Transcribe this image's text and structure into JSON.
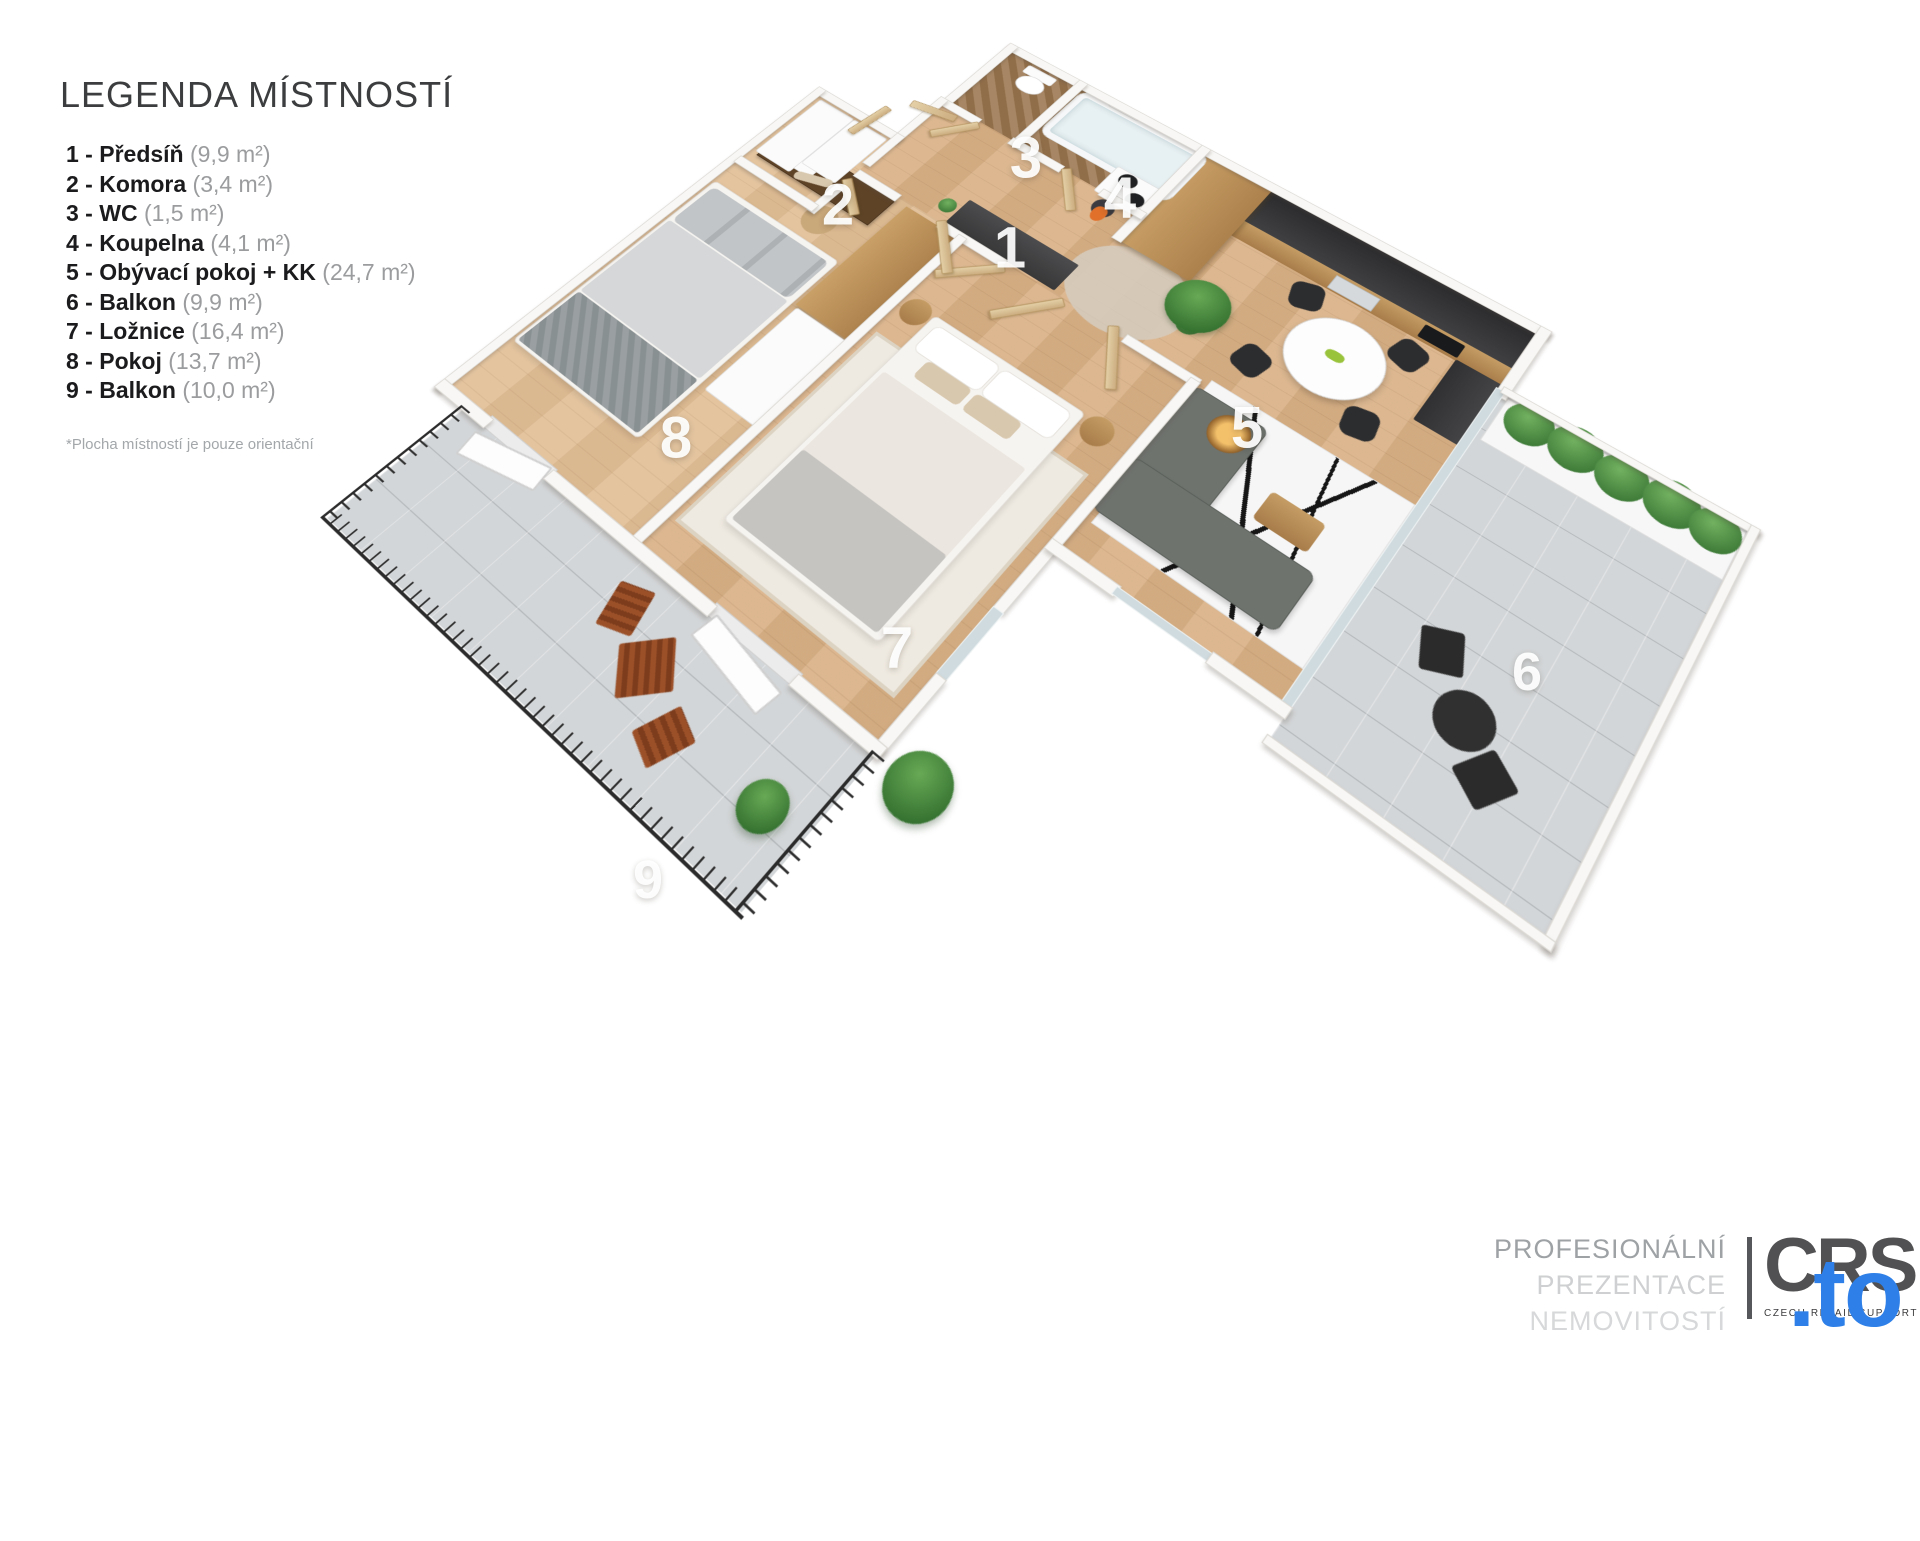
{
  "legend": {
    "title": "LEGENDA MÍSTNOSTÍ",
    "items": [
      {
        "label": "1 - Předsíň",
        "area": "(9,9 m²)"
      },
      {
        "label": "2 - Komora",
        "area": "(3,4 m²)"
      },
      {
        "label": "3 - WC",
        "area": "(1,5 m²)"
      },
      {
        "label": "4 - Koupelna",
        "area": "(4,1 m²)"
      },
      {
        "label": "5 - Obývací pokoj + KK",
        "area": "(24,7 m²)"
      },
      {
        "label": "6 - Balkon",
        "area": "(9,9 m²)"
      },
      {
        "label": "7 - Ložnice",
        "area": "(16,4 m²)"
      },
      {
        "label": "8 - Pokoj",
        "area": "(13,7 m²)"
      },
      {
        "label": "9 - Balkon",
        "area": "(10,0 m²)"
      }
    ],
    "footnote": "*Plocha místností je pouze orientační"
  },
  "plan_labels": [
    "1",
    "2",
    "3",
    "4",
    "5",
    "6",
    "7",
    "8",
    "9"
  ],
  "footer": {
    "lines": [
      "PROFESIONÁLNÍ",
      "PREZENTACE",
      "NEMOVITOSTÍ"
    ],
    "logo_text": "CRS",
    "logo_caption": "CZECH RETAIL SUPPORT",
    "watermark": ".to"
  },
  "colors": {
    "accent_blue": "#2e80e8",
    "logo_gray": "#515153",
    "wood_floor": "#d9b288",
    "stone_floor": "#9c7852",
    "balcony_tile": "#d3d6d8",
    "kitchen_dark": "#333335",
    "wall_white": "#f8f7f5"
  }
}
